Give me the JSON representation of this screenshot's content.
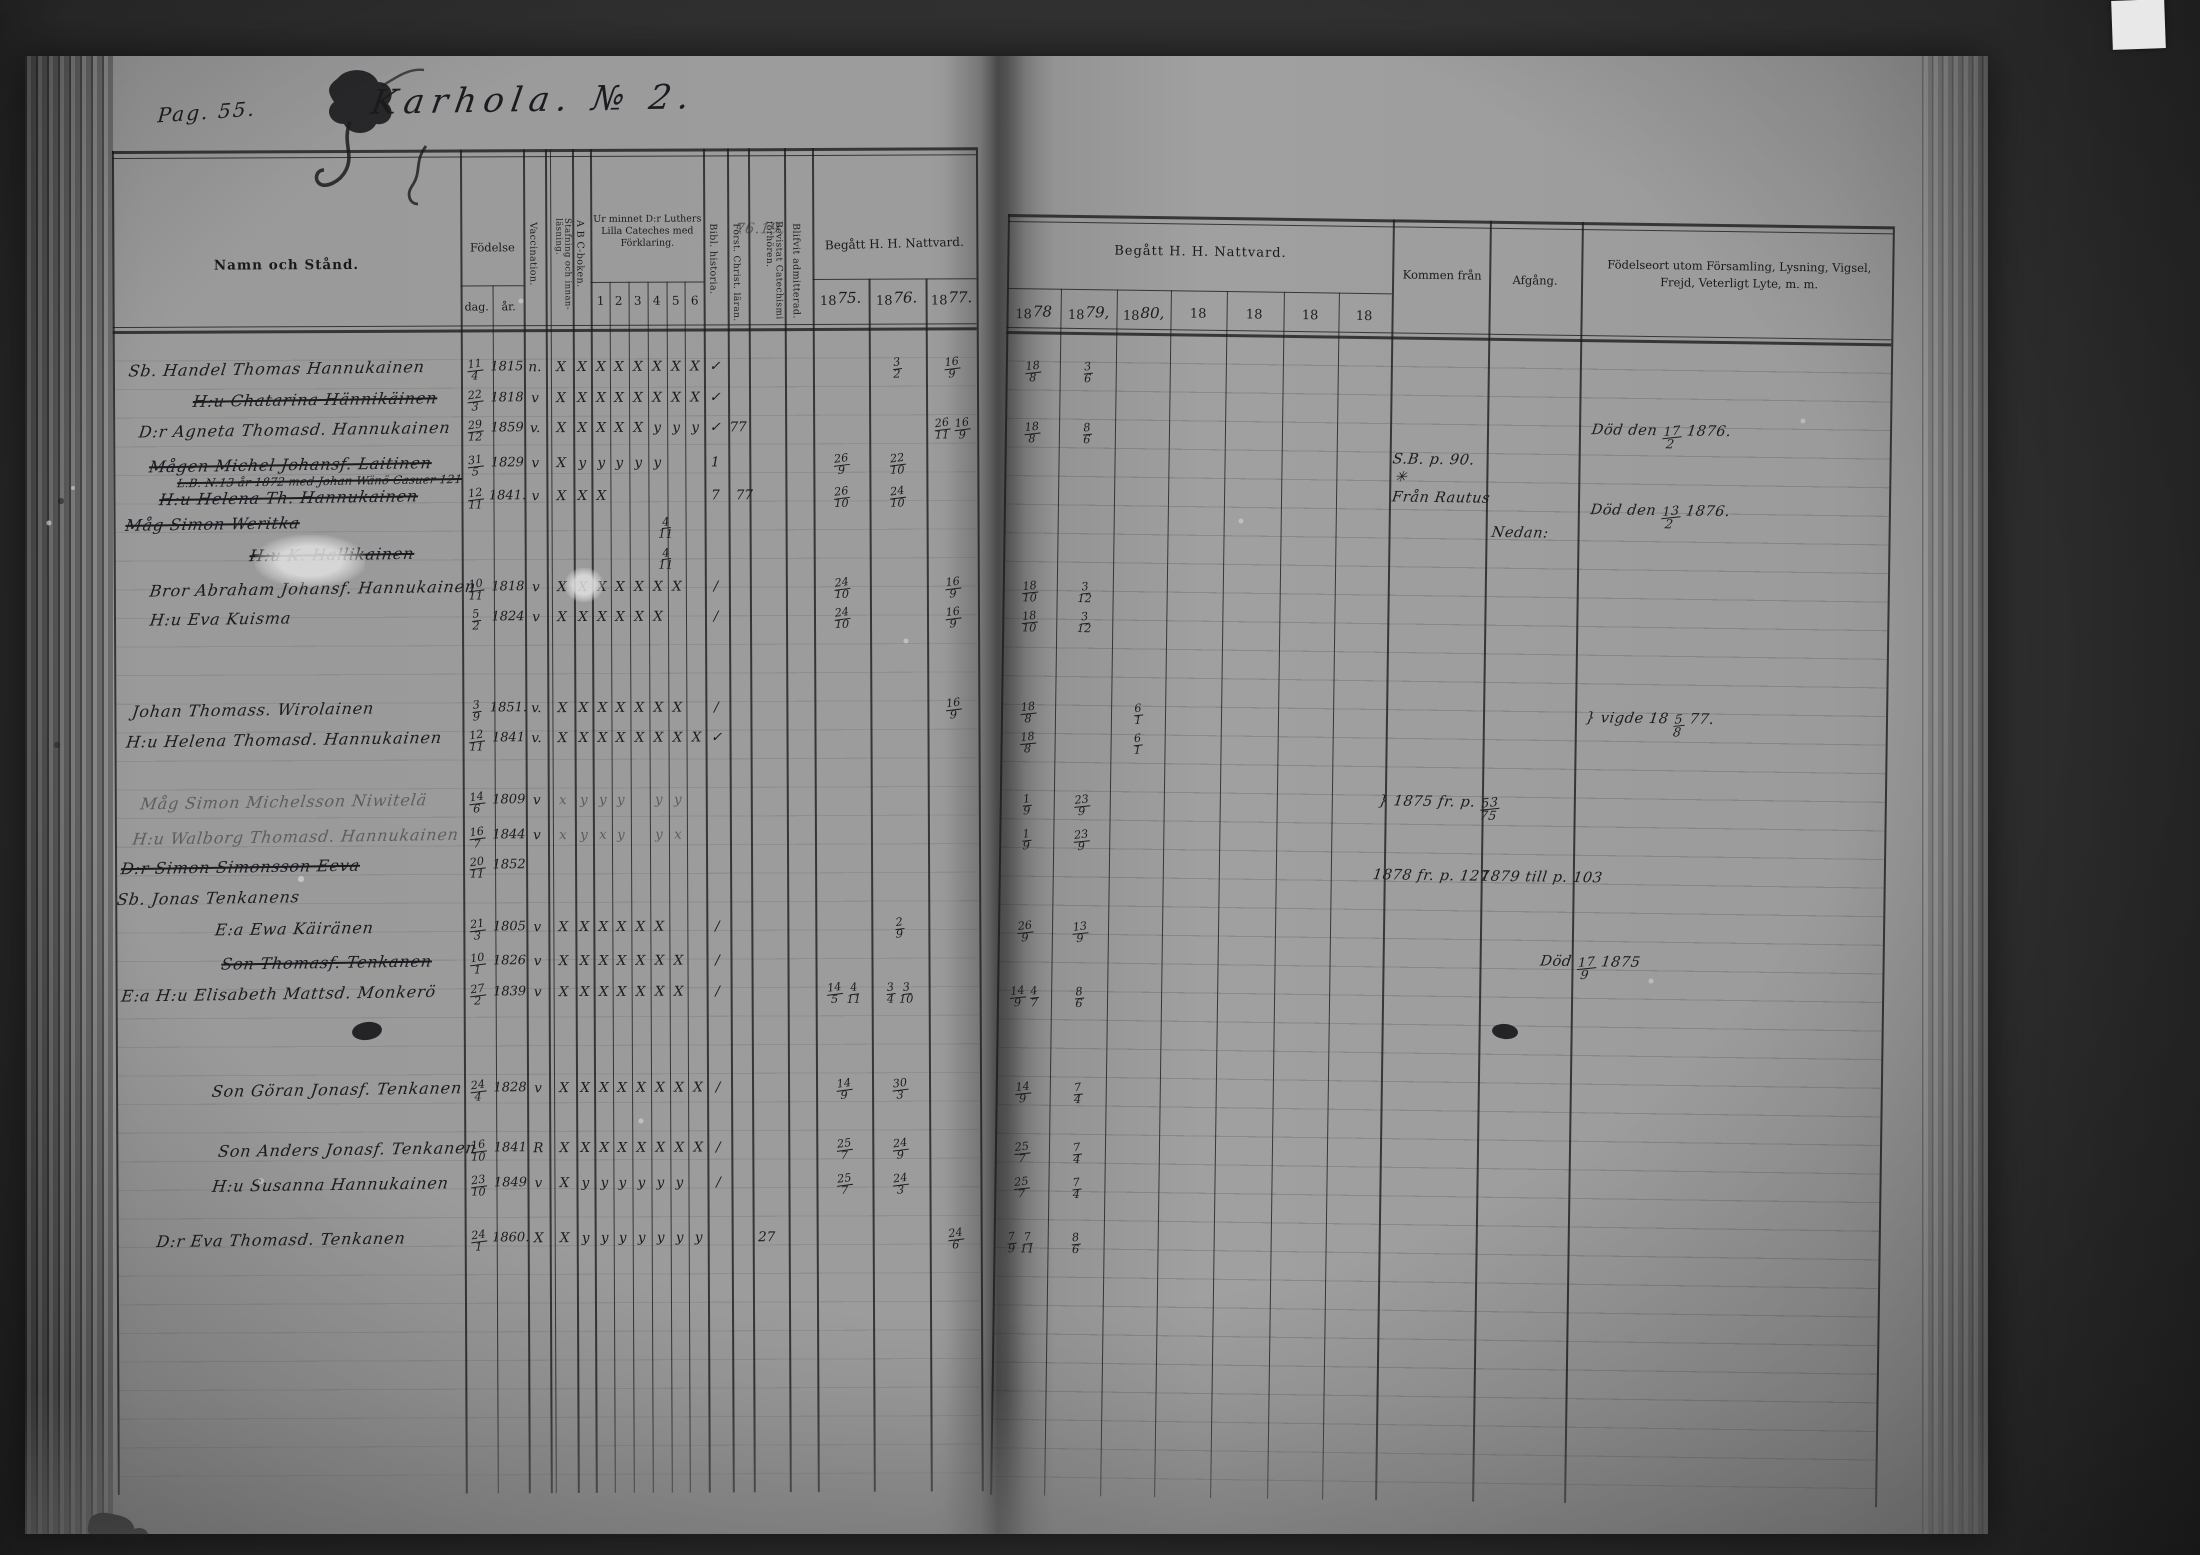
{
  "page": {
    "pag_label": "Pag. 55.",
    "title": "Karhola. № 2."
  },
  "header": {
    "namn": "Namn och Stånd.",
    "fodelse": "Födelse",
    "dag": "dag.",
    "ar": "år.",
    "vaccination": "Vaccination.",
    "stafning": "Stafning och innan-läsning.",
    "abc": "A B C-boken.",
    "cateches": {
      "label": "Ur minnet D:r Luthers Lilla Cateches med Förklaring.",
      "cols": [
        "1",
        "2",
        "3",
        "4",
        "5",
        "6"
      ]
    },
    "bibl": "Bibl. historia.",
    "forst": "Först. Christ. läran.",
    "bevistat": "Bevistat Catechismi förhören.",
    "blifvit": "Blifvit admitterad.",
    "nattvard_left": {
      "label": "Begått H. H. Nattvard.",
      "years": [
        {
          "p": "18",
          "h": "75."
        },
        {
          "p": "18",
          "h": "76."
        },
        {
          "p": "18",
          "h": "77."
        }
      ]
    },
    "nattvard_right": {
      "label": "Begått H. H. Nattvard.",
      "years": [
        {
          "p": "18",
          "h": "78"
        },
        {
          "p": "18",
          "h": "79,"
        },
        {
          "p": "18",
          "h": "80,"
        },
        {
          "p": "18",
          "h": ""
        },
        {
          "p": "18",
          "h": ""
        },
        {
          "p": "18",
          "h": ""
        },
        {
          "p": "18",
          "h": ""
        }
      ]
    },
    "kommen": "Kommen från",
    "afgang": "Afgång.",
    "fodelseort": "Födelseort utom Församling, Lysning, Vigsel, Frejd, Veterligt Lyte, m. m."
  },
  "rows": [
    {
      "y": 372,
      "x": 128,
      "name": "Sb. Handel Thomas Hannukainen",
      "dag": "11/4",
      "ar": "1815",
      "vacc": "n.",
      "marks": "X X X X X X X X",
      "adm": "✓",
      "n76": "3/2",
      "n77": "16/9",
      "n78": "18/8",
      "n79": "3/6"
    },
    {
      "y": 403,
      "x": 192,
      "name": "H:u Chatarina Hännikäinen",
      "struck": true,
      "dag": "22/3",
      "ar": "1818",
      "vacc": "v",
      "marks": "X X X X X X X X",
      "adm": "✓"
    },
    {
      "y": 433,
      "x": 138,
      "name": "D:r Agneta Thomasd. Hannukainen",
      "dag": "29/12",
      "ar": "1859",
      "vacc": "v.",
      "marks": "X X X X X y y y",
      "adm": "✓",
      "extras": [
        {
          "x": 737,
          "t": "77"
        }
      ],
      "n77": "26/11 16/9",
      "n78": "18/8",
      "n79": "8/6"
    },
    {
      "y": 468,
      "x": 148,
      "name": "Mågen Michel Johansf. Laitinen",
      "struck": true,
      "dag": "31/5",
      "ar": "1829",
      "vacc": "v",
      "marks": "X y y y y y · ·",
      "adm": "1",
      "n75": "26/9",
      "n76": "22/10"
    },
    {
      "y": 487,
      "x": 176,
      "name": "L.B. N:13 år 1872 med Johan Wänö Casuer 121",
      "struck": true,
      "small": true
    },
    {
      "y": 501,
      "x": 158,
      "name": "H:u Helena Th. Hannukainen",
      "struck": true,
      "dag": "12/11",
      "ar": "1841.",
      "vacc": "v",
      "marks": "X X X · · · · ·",
      "adm": "7",
      "extras": [
        {
          "x": 743,
          "t": "77"
        }
      ],
      "n75": "26/10",
      "n76": "24/10"
    },
    {
      "y": 527,
      "x": 124,
      "name": "Måg Simon Weritka",
      "struck": true,
      "extras": [
        {
          "x": 664,
          "t": "4/11"
        }
      ]
    },
    {
      "y": 558,
      "x": 248,
      "name": "H:u K. Hallikainen",
      "struck": true,
      "extras": [
        {
          "x": 664,
          "t": "4/11"
        }
      ]
    },
    {
      "y": 592,
      "x": 148,
      "name": "Bror Abraham Johansf. Hannukainen",
      "dag": "10/11",
      "ar": "1818",
      "vacc": "v",
      "marks": "X X X X X X X ·",
      "adm": "/",
      "n75": "24/10",
      "n77": "16/9",
      "n78": "18/10",
      "n79": "3/12"
    },
    {
      "y": 622,
      "x": 148,
      "name": "H:u Eva Kuisma",
      "dag": "5/2",
      "ar": "1824",
      "vacc": "v",
      "marks": "X X X X X X · ·",
      "adm": "/",
      "n75": "24/10",
      "n77": "16/9",
      "n78": "18/10",
      "n79": "3/12"
    },
    {
      "y": 713,
      "x": 130,
      "name": "Johan Thomass. Wirolainen",
      "dag": "3/9",
      "ar": "1851.",
      "vacc": "v.",
      "marks": "X X X X X X X ·",
      "adm": "/",
      "n77": "16/9",
      "n78": "18/8",
      "n80": "6/1"
    },
    {
      "y": 743,
      "x": 124,
      "name": "H:u Helena Thomasd. Hannukainen",
      "dag": "12/11",
      "ar": "1841",
      "vacc": "v.",
      "marks": "X X X X X X X X",
      "adm": "✓",
      "n78": "18/8",
      "n80": "6/1"
    },
    {
      "y": 805,
      "x": 138,
      "name": "Måg Simon Michelsson Niwitelä",
      "dag": "14/6",
      "ar": "1809",
      "vacc": "v",
      "faint": true,
      "marks": "x y y y · y y ·",
      "n78": "1/9",
      "n79": "23/9"
    },
    {
      "y": 840,
      "x": 130,
      "name": "H:u Walborg Thomasd. Hannukainen",
      "dag": "16/7",
      "ar": "1844",
      "vacc": "v",
      "faint": true,
      "marks": "x y x y · y x ·",
      "n78": "1/9",
      "n79": "23/9"
    },
    {
      "y": 870,
      "x": 118,
      "name": "D:r Simon Simonsson Eeva",
      "struck": true,
      "dag": "20/11",
      "ar": "1852"
    },
    {
      "y": 901,
      "x": 114,
      "name": "Sb. Jonas Tenkanens"
    },
    {
      "y": 932,
      "x": 212,
      "name": "E:a Ewa Käiränen",
      "dag": "21/3",
      "ar": "1805",
      "vacc": "v",
      "marks": "X X X X X X · ·",
      "adm": "/",
      "n76": "2/9",
      "n78": "26/9",
      "n79": "13/9"
    },
    {
      "y": 966,
      "x": 218,
      "name": "Son Thomasf. Tenkanen",
      "struck": true,
      "dag": "10/1",
      "ar": "1826",
      "vacc": "v",
      "marks": "X X X X X X X ·",
      "adm": "/"
    },
    {
      "y": 997,
      "x": 118,
      "name": "E:a H:u Elisabeth Mattsd. Monkerö",
      "dag": "27/2",
      "ar": "1839",
      "vacc": "v",
      "marks": "X X X X X X X ·",
      "adm": "/",
      "n75": "14/5 4/11",
      "n76": "3/4 3/10",
      "n78": "14/9 4/7",
      "n79": "8/6"
    },
    {
      "y": 1093,
      "x": 208,
      "name": "Son Göran Jonasf. Tenkanen",
      "dag": "24/4",
      "ar": "1828",
      "vacc": "v",
      "marks": "X X X X X X X X",
      "adm": "/",
      "n75": "14/9",
      "n76": "30/3",
      "n78": "14/9",
      "n79": "7/4"
    },
    {
      "y": 1153,
      "x": 214,
      "name": "Son Anders Jonasf. Tenkanen",
      "dag": "16/10",
      "ar": "1841",
      "vacc": "R",
      "marks": "X X X X X X X X",
      "adm": "/",
      "n75": "25/7",
      "n76": "24/9",
      "n78": "25/7",
      "n79": "7/4"
    },
    {
      "y": 1188,
      "x": 208,
      "name": "H:u Susanna Hannukainen",
      "dag": "23/10",
      "ar": "1849",
      "vacc": "v",
      "marks": "X y y y y y y ·",
      "adm": "/",
      "n75": "25/7",
      "n76": "24/3",
      "n78": "25/7",
      "n79": "7/4"
    },
    {
      "y": 1243,
      "x": 152,
      "name": "D:r Eva Thomasd. Tenkanen",
      "dag": "24/1",
      "ar": "1860.",
      "vacc": "X",
      "marks": "X y y y y y y y",
      "extras": [
        {
          "x": 762,
          "t": "27"
        }
      ],
      "n77": "24/6",
      "n78": "7/9 7/11",
      "n79": "8/6"
    }
  ],
  "annotations": [
    {
      "x": 735,
      "y": 224,
      "t": "76.19,",
      "cls": "faint"
    },
    {
      "x": 1594,
      "y": 414,
      "t": "Död den 17/2 1876."
    },
    {
      "x": 1396,
      "y": 446,
      "t": "S.B. p. 90."
    },
    {
      "x": 1398,
      "y": 464,
      "t": "✳"
    },
    {
      "x": 1396,
      "y": 484,
      "t": "Från Rautus"
    },
    {
      "x": 1594,
      "y": 494,
      "t": "Död den 13/2 1876."
    },
    {
      "x": 1496,
      "y": 518,
      "t": "Nedan:"
    },
    {
      "x": 1592,
      "y": 702,
      "t": "} vigde 18 5/8 77."
    },
    {
      "x": 1386,
      "y": 788,
      "t": "} 1875 fr. p. 53/75"
    },
    {
      "x": 1382,
      "y": 862,
      "t": "1878 fr. p. 127"
    },
    {
      "x": 1490,
      "y": 862,
      "t": "1879 till p. 103"
    },
    {
      "x": 1550,
      "y": 946,
      "t": "Död 17/9 1875"
    }
  ]
}
